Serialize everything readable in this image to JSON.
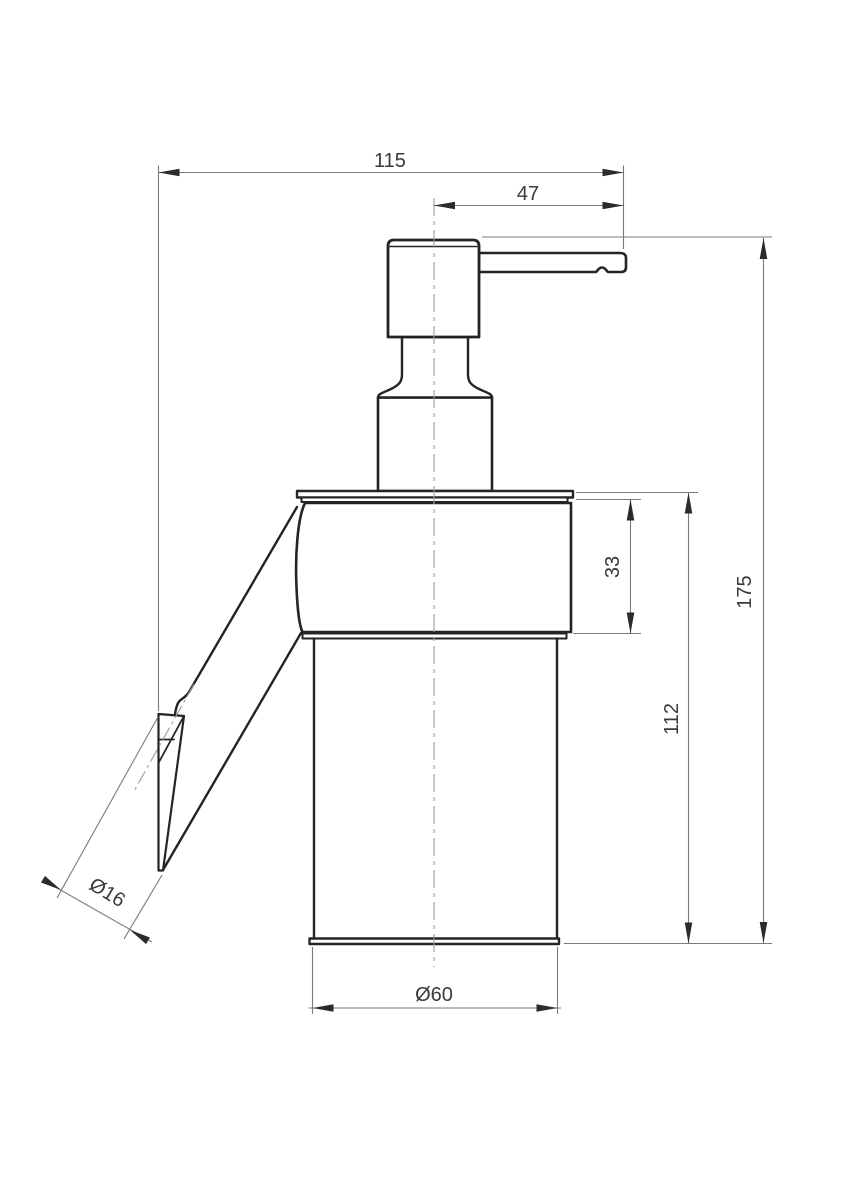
{
  "drawing": {
    "labels": {
      "total_width": "115",
      "spout_reach": "47",
      "total_height": "175",
      "body_height": "112",
      "holder_height": "33",
      "bottle_diameter": "Ø60",
      "mount_diameter": "Ø16"
    },
    "colors": {
      "background": "#ffffff",
      "outline": "#242424",
      "dimension_line": "#7a7a7a",
      "centerline": "#9c9c9c",
      "text": "#3a3a3a"
    }
  }
}
